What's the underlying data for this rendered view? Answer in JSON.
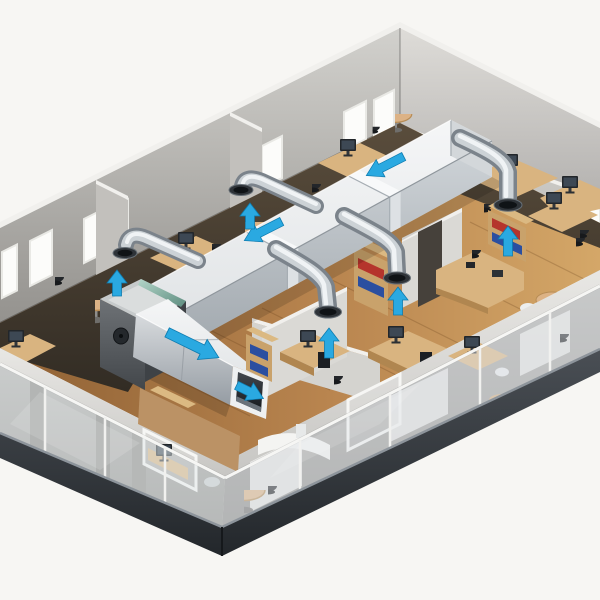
{
  "meta": {
    "type": "isometric-illustration",
    "subject": "office-hvac-ventilation-cutaway",
    "description": "Isometric cutaway illustration of a two-storey office building. A white rectangular ventilation trunk duct runs above the upper-floor rooms into a dark air-handling unit; a large supply duct with an open outlet points toward the viewer; five round galvanized branch elbows serve individual rooms. Cyan arrows indicate airflow direction along the ducts and up through the branch diffusers. The lower storey is enclosed by a translucent glass curtain wall over a dark plinth. Rooms contain wooden desks, monitors, office chairs, bookcases with red and blue binders, and round meeting tables. No text appears in the image."
  },
  "colors": {
    "background": "#f7f6f3",
    "arrow": "#2aa9e1",
    "arrow_edge": "#0e7cb0",
    "window": "#fcfcfa",
    "wood_light": "#d4a768",
    "wood_dark": "#996839",
    "desk": "#d9b480",
    "shelf": "#c9a26b",
    "book_red": "#b5342c",
    "book_blue": "#2b4fa0",
    "seat_dark": "#23262a",
    "white_furniture": "#f4f4f2"
  },
  "airflow": {
    "arrows": [
      {
        "id": "trunk-flow-1",
        "direction": "down-left",
        "kind": "flat",
        "x": 263,
        "y": 231,
        "angle": 153,
        "len": 42,
        "scale": 1
      },
      {
        "id": "trunk-flow-2",
        "direction": "down-left",
        "kind": "flat",
        "x": 385,
        "y": 166,
        "angle": 153,
        "len": 42,
        "scale": 1
      },
      {
        "id": "supply-flow",
        "direction": "down-right",
        "kind": "flat",
        "x": 193,
        "y": 345,
        "angle": 26,
        "len": 50,
        "scale": 1.15
      },
      {
        "id": "outlet-flow",
        "direction": "down-right",
        "kind": "flat",
        "x": 250,
        "y": 392,
        "angle": 26,
        "len": 30,
        "scale": 1
      },
      {
        "id": "diffuser-right",
        "direction": "up",
        "kind": "up",
        "x": 508,
        "y": 241,
        "len": 30
      },
      {
        "id": "diffuser-mid-right",
        "direction": "up",
        "kind": "up",
        "x": 398,
        "y": 301,
        "len": 28
      },
      {
        "id": "diffuser-mid-left",
        "direction": "up",
        "kind": "up",
        "x": 329,
        "y": 343,
        "len": 30
      },
      {
        "id": "diffuser-back-left",
        "direction": "up",
        "kind": "up",
        "x": 117,
        "y": 283,
        "len": 26
      },
      {
        "id": "diffuser-back-mid",
        "direction": "up",
        "kind": "up",
        "x": 250,
        "y": 216,
        "len": 26
      }
    ]
  },
  "windows": {
    "back_wall_slope": -0.5,
    "back_wall": [
      {
        "x": 2,
        "y": 252,
        "w": 15,
        "h": 46
      },
      {
        "x": 30,
        "y": 241,
        "w": 22,
        "h": 45
      },
      {
        "x": 84,
        "y": 219,
        "w": 20,
        "h": 44
      },
      {
        "x": 108,
        "y": 209,
        "w": 20,
        "h": 44
      },
      {
        "x": 232,
        "y": 157,
        "w": 24,
        "h": 42
      },
      {
        "x": 262,
        "y": 146,
        "w": 20,
        "h": 42
      },
      {
        "x": 344,
        "y": 112,
        "w": 22,
        "h": 38
      },
      {
        "x": 374,
        "y": 100,
        "w": 20,
        "h": 38
      }
    ],
    "side_wall": [
      {
        "x": 584,
        "y": 192,
        "w": 16,
        "h": 40,
        "slope": 0.35
      }
    ]
  },
  "inventory": {
    "storeys": 2,
    "air_handling_units": 1,
    "trunk_duct_segments": 3,
    "branch_elbows": 5,
    "flow_arrows_flat": 4,
    "flow_arrows_up": 5,
    "windows_back_wall": 8,
    "bookcases": 4,
    "round_tables": 5,
    "desks_with_monitors": 8
  }
}
